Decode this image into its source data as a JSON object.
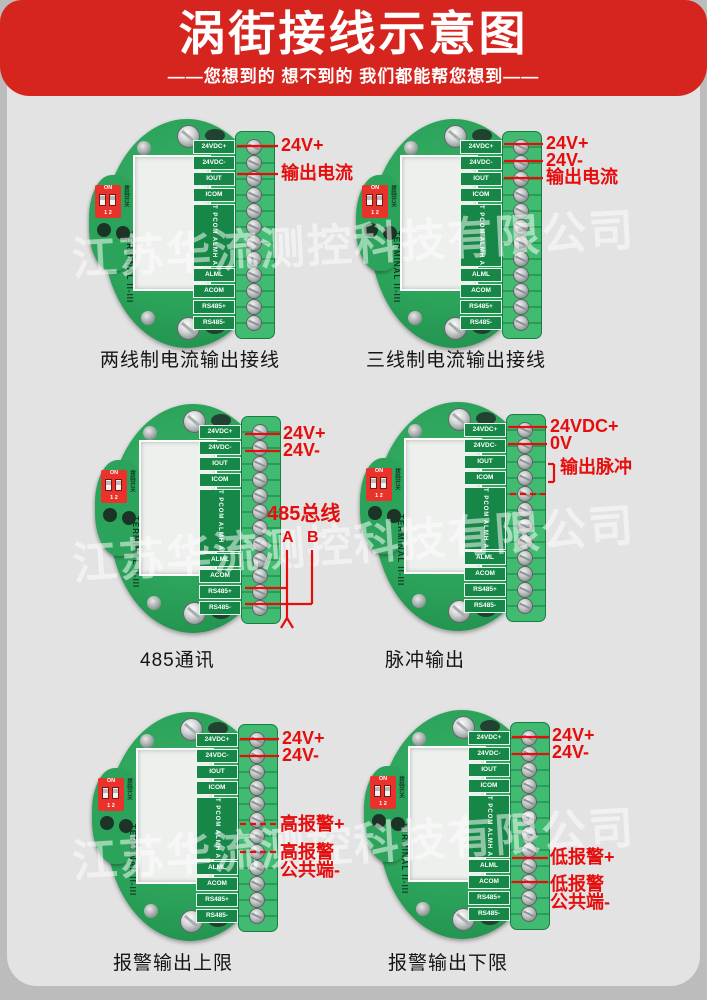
{
  "header": {
    "title": "涡街接线示意图",
    "subtitle": "——您想到的 想不到的 我们都能帮您想到——"
  },
  "watermark": {
    "text": "江苏华流测控科技有限公司"
  },
  "colors": {
    "accent_red": "#e60d0d",
    "header_red": "#d6251e",
    "pcb_green": "#2ca35a"
  },
  "pcb": {
    "terminals_top": [
      "24VDC+",
      "24VDC-",
      "IOUT",
      "ICOM"
    ],
    "terminals_mid_vertical": "POUT PCOM ALMH ACOM",
    "terminals_bottom": [
      "ALML",
      "ACOM",
      "RS485+",
      "RS485-"
    ],
    "dip_on": "ON",
    "dip_numbers": "1 2",
    "dip_side_label": "拨码开关",
    "terminal_side_label": "TERMINAL II-III"
  },
  "boards": [
    {
      "caption": "两线制电流输出接线",
      "origin": {
        "x": 89,
        "y": 119
      },
      "caption_pos": {
        "x": 11,
        "y": 226
      },
      "annotations": [
        {
          "text": "24V+",
          "x": 192,
          "y": 17,
          "size": 18
        },
        {
          "text": "输出电流",
          "x": 192,
          "y": 45,
          "size": 18
        }
      ],
      "lines": [
        [
          148,
          27,
          189,
          27,
          0
        ],
        [
          148,
          55,
          189,
          55,
          0
        ]
      ]
    },
    {
      "caption": "三线制电流输出接线",
      "origin": {
        "x": 356,
        "y": 119
      },
      "caption_pos": {
        "x": 10,
        "y": 226
      },
      "annotations": [
        {
          "text": "24V+",
          "x": 190,
          "y": 15,
          "size": 18
        },
        {
          "text": "24V-",
          "x": 190,
          "y": 32,
          "size": 18
        },
        {
          "text": "输出电流",
          "x": 190,
          "y": 49,
          "size": 18
        }
      ],
      "lines": [
        [
          148,
          25,
          187,
          25,
          0
        ],
        [
          148,
          42,
          187,
          42,
          0
        ],
        [
          148,
          59,
          187,
          59,
          0
        ]
      ]
    },
    {
      "caption": "485通讯",
      "origin": {
        "x": 95,
        "y": 404
      },
      "caption_pos": {
        "x": 45,
        "y": 241
      },
      "annotations": [
        {
          "text": "24V+",
          "x": 188,
          "y": 20,
          "size": 18
        },
        {
          "text": "24V-",
          "x": 188,
          "y": 37,
          "size": 18
        },
        {
          "text": "485总线",
          "x": 172,
          "y": 100,
          "size": 20
        },
        {
          "text": "A",
          "x": 187,
          "y": 126,
          "size": 16
        },
        {
          "text": "B",
          "x": 212,
          "y": 126,
          "size": 16
        }
      ],
      "lines": [
        [
          150,
          30,
          185,
          30,
          0
        ],
        [
          150,
          47,
          185,
          47,
          0
        ],
        [
          150,
          184,
          192,
          184,
          0
        ],
        [
          150,
          200,
          217,
          200,
          0
        ],
        [
          192,
          146,
          192,
          214,
          0
        ],
        [
          217,
          146,
          217,
          200,
          0
        ],
        [
          192,
          214,
          186,
          224,
          0
        ],
        [
          192,
          214,
          198,
          224,
          0
        ]
      ]
    },
    {
      "caption": "脉冲输出",
      "origin": {
        "x": 360,
        "y": 402
      },
      "caption_pos": {
        "x": 25,
        "y": 243
      },
      "annotations": [
        {
          "text": "24VDC+",
          "x": 190,
          "y": 15,
          "size": 18
        },
        {
          "text": "0V",
          "x": 190,
          "y": 32,
          "size": 18
        },
        {
          "text": "输出脉冲",
          "x": 200,
          "y": 56,
          "size": 18
        }
      ],
      "lines": [
        [
          148,
          25,
          187,
          25,
          0
        ],
        [
          148,
          42,
          187,
          42,
          0
        ],
        [
          188,
          62,
          194,
          62,
          0
        ],
        [
          194,
          62,
          194,
          80,
          0
        ],
        [
          188,
          80,
          194,
          80,
          0
        ],
        [
          150,
          92,
          190,
          92,
          1
        ]
      ]
    },
    {
      "caption": "报警输出上限",
      "origin": {
        "x": 92,
        "y": 712
      },
      "caption_pos": {
        "x": 21,
        "y": 236
      },
      "annotations": [
        {
          "text": "24V+",
          "x": 190,
          "y": 17,
          "size": 18
        },
        {
          "text": "24V-",
          "x": 190,
          "y": 34,
          "size": 18
        },
        {
          "text": "高报警+",
          "x": 188,
          "y": 103,
          "size": 18
        },
        {
          "text": "高报警",
          "x": 188,
          "y": 131,
          "size": 18
        },
        {
          "text": "公共端-",
          "x": 188,
          "y": 149,
          "size": 18
        }
      ],
      "lines": [
        [
          148,
          27,
          187,
          27,
          0
        ],
        [
          148,
          44,
          187,
          44,
          0
        ],
        [
          148,
          112,
          186,
          112,
          1
        ],
        [
          148,
          140,
          186,
          140,
          1
        ]
      ]
    },
    {
      "caption": "报警输出下限",
      "origin": {
        "x": 364,
        "y": 710
      },
      "caption_pos": {
        "x": 24,
        "y": 238
      },
      "annotations": [
        {
          "text": "24V+",
          "x": 188,
          "y": 16,
          "size": 18
        },
        {
          "text": "24V-",
          "x": 188,
          "y": 33,
          "size": 18
        },
        {
          "text": "低报警+",
          "x": 186,
          "y": 138,
          "size": 18
        },
        {
          "text": "低报警",
          "x": 186,
          "y": 165,
          "size": 18
        },
        {
          "text": "公共端-",
          "x": 186,
          "y": 183,
          "size": 18
        }
      ],
      "lines": [
        [
          148,
          27,
          185,
          27,
          0
        ],
        [
          148,
          44,
          185,
          44,
          0
        ],
        [
          148,
          148,
          184,
          148,
          0
        ],
        [
          148,
          172,
          184,
          172,
          0
        ]
      ]
    }
  ]
}
